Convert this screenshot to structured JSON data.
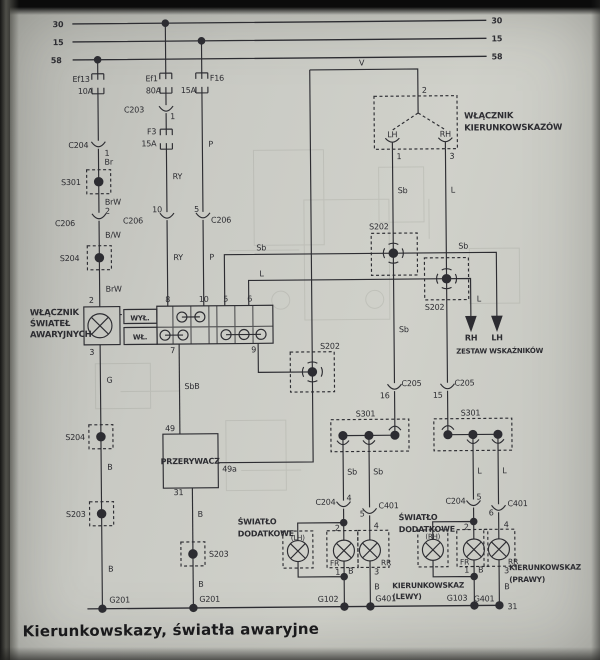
{
  "footer": {
    "title": "Kierunkowskazy, światła awaryjne"
  },
  "colors": {
    "paper": "#c9cac4",
    "ink": "#2d2d32",
    "ghost": "#8e9088"
  },
  "diagram": {
    "bus_terminals": [
      "30",
      "15",
      "58"
    ],
    "labels": [
      {
        "id": "bus30-left",
        "t": "30",
        "x": 66,
        "y": 25,
        "a": "e",
        "b": 1
      },
      {
        "id": "bus15-left",
        "t": "15",
        "x": 66,
        "y": 43,
        "a": "e",
        "b": 1
      },
      {
        "id": "bus58-left",
        "t": "58",
        "x": 64,
        "y": 61,
        "a": "e",
        "b": 1
      },
      {
        "id": "bus30-right",
        "t": "30",
        "x": 494,
        "y": 25,
        "a": "s",
        "b": 1
      },
      {
        "id": "bus15-right",
        "t": "15",
        "x": 494,
        "y": 43,
        "a": "s",
        "b": 1
      },
      {
        "id": "bus58-right",
        "t": "58",
        "x": 494,
        "y": 61,
        "a": "s",
        "b": 1
      },
      {
        "id": "fuse-ef13",
        "t": "Ef13",
        "x": 92,
        "y": 80,
        "a": "e"
      },
      {
        "id": "fuse-ef13-amp",
        "t": "10A",
        "x": 95,
        "y": 92,
        "a": "e"
      },
      {
        "id": "fuse-ef1",
        "t": "Ef1",
        "x": 160,
        "y": 80,
        "a": "e"
      },
      {
        "id": "fuse-ef1-amp",
        "t": "80A",
        "x": 163,
        "y": 92,
        "a": "e"
      },
      {
        "id": "fuse-f16",
        "t": "F16",
        "x": 212,
        "y": 80,
        "a": "s"
      },
      {
        "id": "fuse-f16-amp",
        "t": "15A",
        "x": 198,
        "y": 92,
        "a": "e"
      },
      {
        "id": "conn-c203",
        "t": "C203",
        "x": 146,
        "y": 111,
        "a": "e"
      },
      {
        "id": "conn-c203-pin",
        "t": "1",
        "x": 172,
        "y": 118,
        "a": "s"
      },
      {
        "id": "fuse-f3",
        "t": "F3",
        "x": 158,
        "y": 133,
        "a": "e"
      },
      {
        "id": "fuse-f3-amp",
        "t": "15A",
        "x": 158,
        "y": 145,
        "a": "e"
      },
      {
        "id": "wire-br",
        "t": "Br",
        "x": 106,
        "y": 163,
        "a": "s"
      },
      {
        "id": "conn-c204-top",
        "t": "C204",
        "x": 90,
        "y": 146,
        "a": "e"
      },
      {
        "id": "conn-c204-top-pin",
        "t": "1",
        "x": 106,
        "y": 154,
        "a": "s"
      },
      {
        "id": "splice-s301-a",
        "t": "S301",
        "x": 82,
        "y": 183,
        "a": "e"
      },
      {
        "id": "wire-brw1",
        "t": "BrW",
        "x": 106,
        "y": 203,
        "a": "s"
      },
      {
        "id": "conn-c206-a-pin",
        "t": "2",
        "x": 106,
        "y": 212,
        "a": "s"
      },
      {
        "id": "conn-c206-a",
        "t": "C206",
        "x": 76,
        "y": 224,
        "a": "e"
      },
      {
        "id": "wire-bw",
        "t": "B/W",
        "x": 106,
        "y": 236,
        "a": "s"
      },
      {
        "id": "splice-s204-a",
        "t": "S204",
        "x": 80,
        "y": 259,
        "a": "e"
      },
      {
        "id": "wire-brw2",
        "t": "BrW",
        "x": 106,
        "y": 290,
        "a": "s"
      },
      {
        "id": "hazard-pin2",
        "t": "2",
        "x": 94,
        "y": 301,
        "a": "e"
      },
      {
        "id": "hazard-pin3",
        "t": "3",
        "x": 94,
        "y": 353,
        "a": "e"
      },
      {
        "id": "wire-g",
        "t": "G",
        "x": 106,
        "y": 381,
        "a": "s"
      },
      {
        "id": "splice-s204-b",
        "t": "S204",
        "x": 84,
        "y": 438,
        "a": "e"
      },
      {
        "id": "wire-b1",
        "t": "B",
        "x": 106,
        "y": 468,
        "a": "s"
      },
      {
        "id": "splice-s203-a",
        "t": "S203",
        "x": 84,
        "y": 515,
        "a": "e"
      },
      {
        "id": "wire-b2",
        "t": "B",
        "x": 106,
        "y": 570,
        "a": "s"
      },
      {
        "id": "ground-g201-a",
        "t": "G201",
        "x": 107,
        "y": 601,
        "a": "s"
      },
      {
        "id": "wire-ry1",
        "t": "RY",
        "x": 174,
        "y": 178,
        "a": "s"
      },
      {
        "id": "conn-c206-b-pin",
        "t": "10",
        "x": 163,
        "y": 211,
        "a": "e"
      },
      {
        "id": "conn-c206-b",
        "t": "C206",
        "x": 144,
        "y": 222,
        "a": "e"
      },
      {
        "id": "wire-ry2",
        "t": "RY",
        "x": 174,
        "y": 259,
        "a": "s"
      },
      {
        "id": "wire-p1",
        "t": "P",
        "x": 210,
        "y": 146,
        "a": "s"
      },
      {
        "id": "conn-c206-c-pin",
        "t": "5",
        "x": 200,
        "y": 211,
        "a": "e"
      },
      {
        "id": "conn-c206-c",
        "t": "C206",
        "x": 212,
        "y": 222,
        "a": "s"
      },
      {
        "id": "wire-p2",
        "t": "P",
        "x": 210,
        "y": 259,
        "a": "s"
      },
      {
        "id": "hazard-switch-name-1",
        "t": "WŁĄCZNIK",
        "x": 30,
        "y": 313,
        "a": "s",
        "b": 1,
        "fs": 8.5
      },
      {
        "id": "hazard-switch-name-2",
        "t": "ŚWIATEŁ",
        "x": 30,
        "y": 324,
        "a": "s",
        "b": 1,
        "fs": 8.5
      },
      {
        "id": "hazard-switch-name-3",
        "t": "AWARYJNYCH",
        "x": 30,
        "y": 335,
        "a": "s",
        "b": 1,
        "fs": 8.5
      },
      {
        "id": "hazard-off",
        "t": "WYŁ.",
        "x": 140,
        "y": 319,
        "a": "m",
        "b": 1,
        "fs": 7
      },
      {
        "id": "hazard-on",
        "t": "WŁ.",
        "x": 140,
        "y": 338,
        "a": "m",
        "b": 1,
        "fs": 7
      },
      {
        "id": "hazard-pin8",
        "t": "8",
        "x": 168,
        "y": 301,
        "a": "m"
      },
      {
        "id": "hazard-pin10",
        "t": "10",
        "x": 204,
        "y": 301,
        "a": "m"
      },
      {
        "id": "hazard-pin5",
        "t": "5",
        "x": 226,
        "y": 301,
        "a": "m"
      },
      {
        "id": "hazard-pin6",
        "t": "6",
        "x": 250,
        "y": 301,
        "a": "m"
      },
      {
        "id": "hazard-pin7",
        "t": "7",
        "x": 175,
        "y": 352,
        "a": "e"
      },
      {
        "id": "hazard-pin9",
        "t": "9",
        "x": 256,
        "y": 352,
        "a": "e"
      },
      {
        "id": "wire-v",
        "t": "V",
        "x": 364,
        "y": 66,
        "a": "m"
      },
      {
        "id": "wire-sbb",
        "t": "SbB",
        "x": 184,
        "y": 388,
        "a": "s"
      },
      {
        "id": "wire-sb-h",
        "t": "Sb",
        "x": 262,
        "y": 250,
        "a": "m"
      },
      {
        "id": "wire-l-h",
        "t": "L",
        "x": 262,
        "y": 276,
        "a": "m"
      },
      {
        "id": "wire-sb-h2",
        "t": "Sb",
        "x": 464,
        "y": 250,
        "a": "m"
      },
      {
        "id": "wire-l-v2",
        "t": "L",
        "x": 477,
        "y": 303,
        "a": "s"
      },
      {
        "id": "wire-sb-v1",
        "t": "Sb",
        "x": 399,
        "y": 194,
        "a": "s"
      },
      {
        "id": "wire-l-v1",
        "t": "L",
        "x": 452,
        "y": 194,
        "a": "s"
      },
      {
        "id": "splice-s202-1",
        "t": "S202",
        "x": 370,
        "y": 230,
        "a": "s"
      },
      {
        "id": "splice-s202-2",
        "t": "S202",
        "x": 425,
        "y": 311,
        "a": "s"
      },
      {
        "id": "splice-s202-3",
        "t": "S202",
        "x": 320,
        "y": 349,
        "a": "s"
      },
      {
        "id": "arrow-rh",
        "t": "RH",
        "x": 471,
        "y": 342,
        "a": "m",
        "b": 1
      },
      {
        "id": "arrow-lh",
        "t": "LH",
        "x": 497,
        "y": 342,
        "a": "m",
        "b": 1
      },
      {
        "id": "cluster-name",
        "t": "ZESTAW WSKAŹNIKÓW",
        "x": 456,
        "y": 355,
        "a": "s",
        "b": 1,
        "fs": 7
      },
      {
        "id": "ts-pin2",
        "t": "2",
        "x": 424,
        "y": 94,
        "a": "s"
      },
      {
        "id": "ts-switch-name-1",
        "t": "WŁĄCZNIK",
        "x": 466,
        "y": 120,
        "a": "s",
        "b": 1,
        "fs": 8.5
      },
      {
        "id": "ts-switch-name-2",
        "t": "KIERUNKOWSKAZÓW",
        "x": 466,
        "y": 132,
        "a": "s",
        "b": 1,
        "fs": 8.5
      },
      {
        "id": "ts-lh",
        "t": "LH",
        "x": 394,
        "y": 138,
        "a": "m"
      },
      {
        "id": "ts-rh",
        "t": "RH",
        "x": 447,
        "y": 138,
        "a": "m"
      },
      {
        "id": "ts-pin1",
        "t": "1",
        "x": 398,
        "y": 160,
        "a": "s"
      },
      {
        "id": "ts-pin3",
        "t": "3",
        "x": 451,
        "y": 160,
        "a": "s"
      },
      {
        "id": "wire-sb-v2",
        "t": "Sb",
        "x": 399,
        "y": 333,
        "a": "s"
      },
      {
        "id": "conn-c205-a-pin",
        "t": "16",
        "x": 389,
        "y": 399,
        "a": "e"
      },
      {
        "id": "conn-c205-a",
        "t": "C205",
        "x": 401,
        "y": 387,
        "a": "s"
      },
      {
        "id": "conn-c205-b-pin",
        "t": "15",
        "x": 442,
        "y": 399,
        "a": "e"
      },
      {
        "id": "conn-c205-b",
        "t": "C205",
        "x": 454,
        "y": 387,
        "a": "s"
      },
      {
        "id": "splice-s301-b",
        "t": "S301",
        "x": 355,
        "y": 417,
        "a": "s"
      },
      {
        "id": "splice-s301-c",
        "t": "S301",
        "x": 460,
        "y": 417,
        "a": "s"
      },
      {
        "id": "wire-sb-d1",
        "t": "Sb",
        "x": 346,
        "y": 475,
        "a": "s"
      },
      {
        "id": "wire-sb-d2",
        "t": "Sb",
        "x": 372,
        "y": 475,
        "a": "s"
      },
      {
        "id": "wire-l-d1",
        "t": "L",
        "x": 476,
        "y": 475,
        "a": "s"
      },
      {
        "id": "wire-l-d2",
        "t": "L",
        "x": 501,
        "y": 475,
        "a": "s"
      },
      {
        "id": "conn-c204-b",
        "t": "C204",
        "x": 334,
        "y": 505,
        "a": "e"
      },
      {
        "id": "conn-c204-b-pin",
        "t": "4",
        "x": 345,
        "y": 501,
        "a": "s"
      },
      {
        "id": "conn-c401-a",
        "t": "C401",
        "x": 377,
        "y": 509,
        "a": "s"
      },
      {
        "id": "conn-c401-a-pin",
        "t": "5",
        "x": 363,
        "y": 517,
        "a": "e"
      },
      {
        "id": "conn-c204-c",
        "t": "C204",
        "x": 464,
        "y": 505,
        "a": "e"
      },
      {
        "id": "conn-c204-c-pin",
        "t": "5",
        "x": 475,
        "y": 501,
        "a": "s"
      },
      {
        "id": "conn-c401-b",
        "t": "C401",
        "x": 506,
        "y": 508,
        "a": "s"
      },
      {
        "id": "conn-c401-b-pin",
        "t": "6",
        "x": 492,
        "y": 517,
        "a": "e"
      },
      {
        "id": "extra-lamp-left-1",
        "t": "ŚWIATŁO",
        "x": 236,
        "y": 524,
        "a": "s",
        "b": 1
      },
      {
        "id": "extra-lamp-left-2",
        "t": "DODATKOWE",
        "x": 236,
        "y": 536,
        "a": "s",
        "b": 1
      },
      {
        "id": "extra-lamp-right-1",
        "t": "ŚWIATŁO",
        "x": 397,
        "y": 521,
        "a": "s",
        "b": 1
      },
      {
        "id": "extra-lamp-right-2",
        "t": "DODATKOWE",
        "x": 397,
        "y": 533,
        "a": "s",
        "b": 1
      },
      {
        "id": "lamp-lh",
        "t": "(LH)",
        "x": 296,
        "y": 540,
        "a": "m",
        "fs": 7
      },
      {
        "id": "lamp-rh",
        "t": "(RH)",
        "x": 431,
        "y": 540,
        "a": "m",
        "fs": 7
      },
      {
        "id": "lamp-fr-left",
        "t": "FR",
        "x": 328,
        "y": 566,
        "a": "s",
        "fs": 7.5
      },
      {
        "id": "lamp-rr-left",
        "t": "RR",
        "x": 379,
        "y": 566,
        "a": "s",
        "fs": 7.5
      },
      {
        "id": "lamp-fr-right",
        "t": "FR",
        "x": 458,
        "y": 566,
        "a": "s",
        "fs": 7.5
      },
      {
        "id": "lamp-rr-right",
        "t": "RR",
        "x": 506,
        "y": 566,
        "a": "s",
        "fs": 7.5
      },
      {
        "id": "lamp-left-pin2",
        "t": "2",
        "x": 338,
        "y": 531,
        "a": "e"
      },
      {
        "id": "lamp-left-pin1",
        "t": "1",
        "x": 338,
        "y": 575,
        "a": "e"
      },
      {
        "id": "wire-b-left1",
        "t": "B",
        "x": 346,
        "y": 574,
        "a": "s"
      },
      {
        "id": "lamp-left-pin4",
        "t": "4",
        "x": 372,
        "y": 529,
        "a": "s"
      },
      {
        "id": "lamp-left-pin3",
        "t": "3",
        "x": 372,
        "y": 575,
        "a": "s"
      },
      {
        "id": "wire-b-left2",
        "t": "B",
        "x": 372,
        "y": 590,
        "a": "s"
      },
      {
        "id": "ground-g102",
        "t": "G102",
        "x": 336,
        "y": 602,
        "a": "e"
      },
      {
        "id": "ground-g401-a",
        "t": "G401",
        "x": 373,
        "y": 602,
        "a": "s"
      },
      {
        "id": "ts-left-name-1",
        "t": "KIERUNKOWSKAZ",
        "x": 390,
        "y": 589,
        "a": "s",
        "b": 1,
        "fs": 7.5
      },
      {
        "id": "ts-left-name-2",
        "t": "(LEWY)",
        "x": 390,
        "y": 600,
        "a": "s",
        "b": 1,
        "fs": 7.5
      },
      {
        "id": "lamp-right-pin2",
        "t": "2",
        "x": 467,
        "y": 531,
        "a": "e"
      },
      {
        "id": "lamp-right-pin1",
        "t": "1",
        "x": 467,
        "y": 574,
        "a": "e"
      },
      {
        "id": "wire-b-right1",
        "t": "B",
        "x": 476,
        "y": 574,
        "a": "s"
      },
      {
        "id": "lamp-right-pin4",
        "t": "4",
        "x": 502,
        "y": 529,
        "a": "s"
      },
      {
        "id": "lamp-right-pin3",
        "t": "3",
        "x": 502,
        "y": 575,
        "a": "s"
      },
      {
        "id": "wire-b-right2",
        "t": "B",
        "x": 502,
        "y": 591,
        "a": "s"
      },
      {
        "id": "ground-g103",
        "t": "G103",
        "x": 465,
        "y": 602,
        "a": "e"
      },
      {
        "id": "ground-g401-b",
        "t": "G401",
        "x": 492,
        "y": 603,
        "a": "e"
      },
      {
        "id": "terminal-31",
        "t": "31",
        "x": 505,
        "y": 611,
        "a": "s"
      },
      {
        "id": "ts-right-name-1",
        "t": "KIERUNKOWSKAZ",
        "x": 507,
        "y": 572,
        "a": "s",
        "b": 1,
        "fs": 7.5
      },
      {
        "id": "ts-right-name-2",
        "t": "(PRAWY)",
        "x": 507,
        "y": 584,
        "a": "s",
        "b": 1,
        "fs": 7.5
      },
      {
        "id": "flasher-name",
        "t": "PRZERYWACZ",
        "x": 189,
        "y": 463,
        "a": "m",
        "b": 1,
        "fs": 8
      },
      {
        "id": "flasher-pin49",
        "t": "49",
        "x": 174,
        "y": 430,
        "a": "e"
      },
      {
        "id": "flasher-pin49a",
        "t": "49a",
        "x": 221,
        "y": 471,
        "a": "s"
      },
      {
        "id": "flasher-pin31",
        "t": "31",
        "x": 182,
        "y": 494,
        "a": "e"
      },
      {
        "id": "wire-b3",
        "t": "B",
        "x": 196,
        "y": 516,
        "a": "s"
      },
      {
        "id": "splice-s203-b",
        "t": "S203",
        "x": 207,
        "y": 556,
        "a": "s"
      },
      {
        "id": "wire-b4",
        "t": "B",
        "x": 196,
        "y": 586,
        "a": "s"
      },
      {
        "id": "ground-g201-b",
        "t": "G201",
        "x": 197,
        "y": 601,
        "a": "s"
      }
    ]
  }
}
